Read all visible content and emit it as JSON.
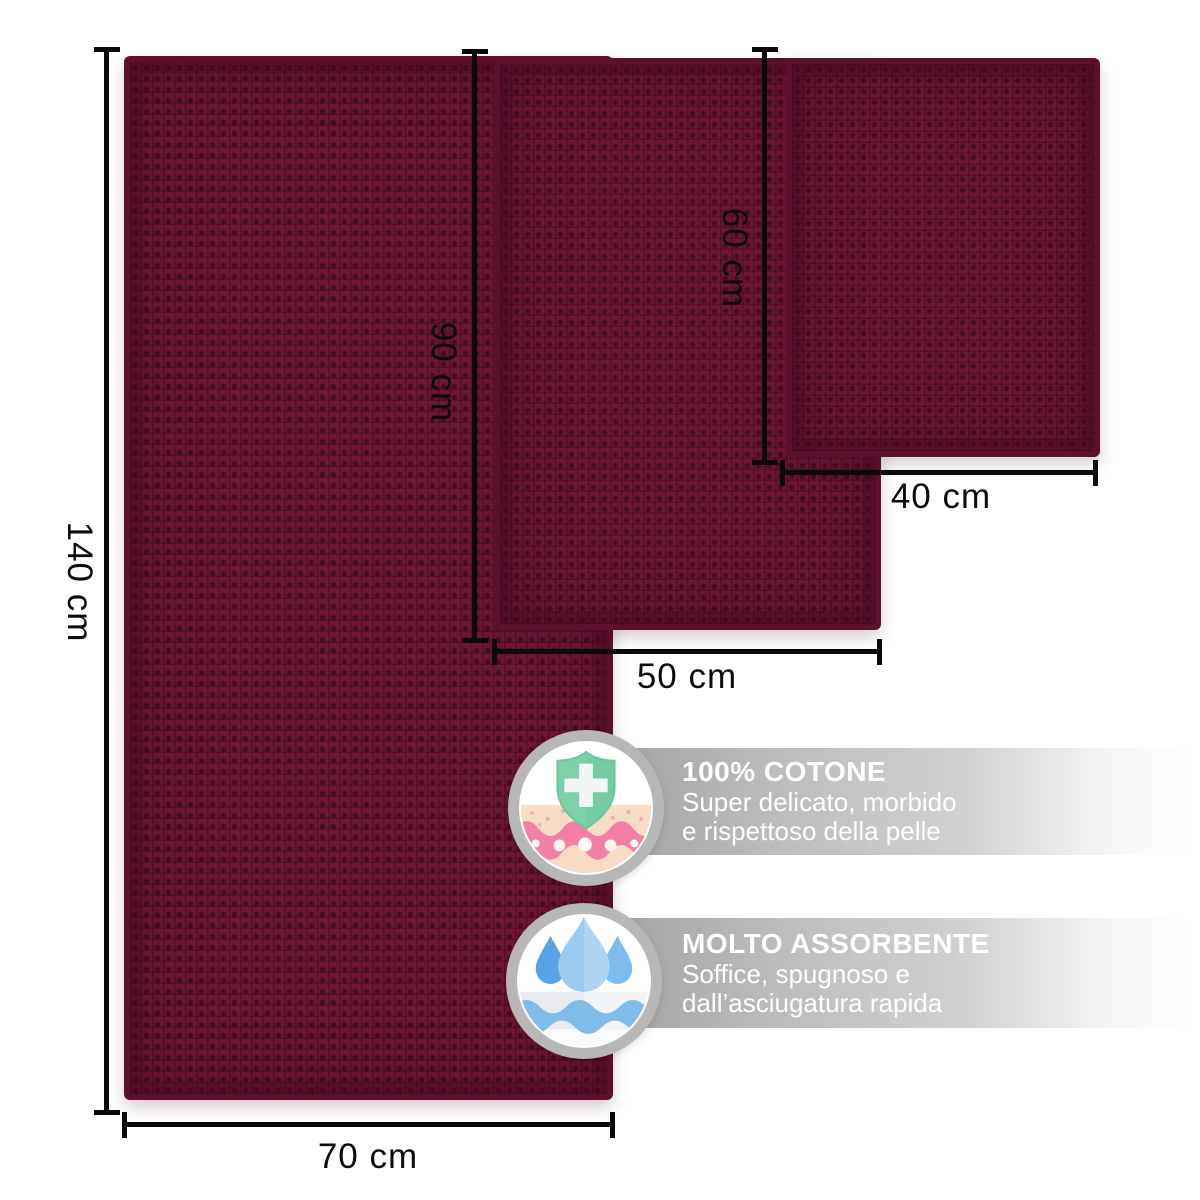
{
  "product_diagram": {
    "towels": [
      {
        "name": "large-towel",
        "width_label": "70 cm",
        "height_label": "140 cm"
      },
      {
        "name": "medium-towel",
        "width_label": "50 cm",
        "height_label": "90 cm"
      },
      {
        "name": "small-towel",
        "width_label": "40 cm",
        "height_label": "60 cm"
      }
    ],
    "fabric_color": "#6d1634"
  },
  "features": [
    {
      "icon": "shield-skin-icon",
      "title": "100% COTONE",
      "line1": "Super delicato, morbido",
      "line2": "e rispettoso della pelle"
    },
    {
      "icon": "water-drops-icon",
      "title": "MOLTO ASSORBENTE",
      "line1": "Soffice, spugnoso e",
      "line2": "dall’asciugatura rapida"
    }
  ],
  "style": {
    "dimension_line_color": "#0a0a0a",
    "badge_ring_color": "#b7b7b8",
    "banner_text_color": "#ffffff",
    "shield_green": "#7dd0a8",
    "drop_blue": "#57a3e6",
    "skin_pink": "#f47fa6"
  }
}
